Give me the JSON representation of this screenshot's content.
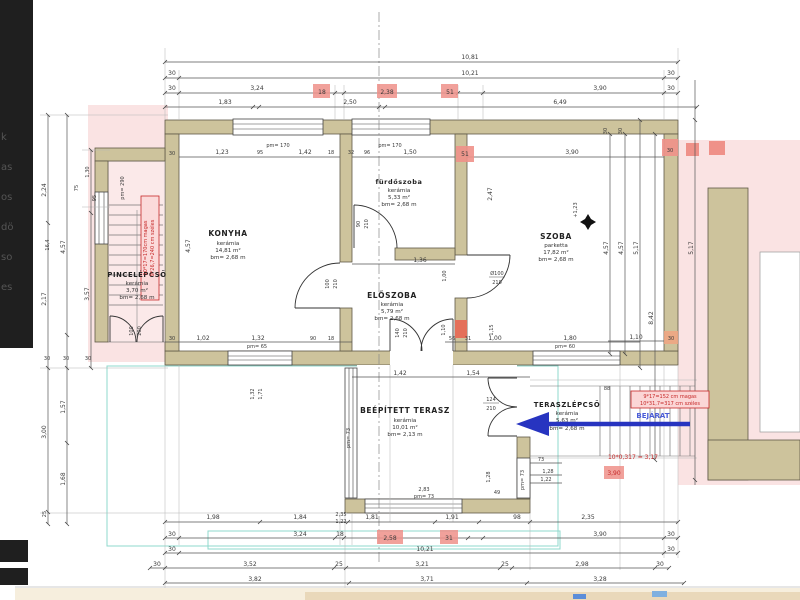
{
  "colors": {
    "wall": "#cdc39c",
    "pink_overlay": "#fae3e3",
    "red_highlight": "#ef9189",
    "red_wall_segment": "#e4705a",
    "red_note": "#c62828",
    "cyan_box": "#8fd8cc",
    "blue_arrow": "#2734c0",
    "blue_text": "#4a5cd8",
    "bottom_strip_tan": "#e9d8ba",
    "bottom_strip_cream": "#f6eedd"
  },
  "rooms": [
    {
      "name": "KONYHA",
      "material": "kerámia",
      "area": "14,81 m²",
      "height": "bm= 2,68 m"
    },
    {
      "name": "fürdőszoba",
      "material": "kerámia",
      "area": "5,33 m²",
      "height": "bm= 2,68 m"
    },
    {
      "name": "SZOBA",
      "material": "parketta",
      "area": "17,82 m²",
      "height": "bm= 2,68 m"
    },
    {
      "name": "ELŐSZOBA",
      "material": "kerámia",
      "area": "5,79 m²",
      "height": "bm= 2,68 m"
    },
    {
      "name": "PINCELÉPCSŐ",
      "material": "kerámia",
      "area": "3,70 m²",
      "height": "bm= 2,68 m"
    },
    {
      "name": "BEÉPÍTETT TERASZ",
      "material": "kerámia",
      "area": "10,01 m²",
      "height": "bm= 2,13 m"
    },
    {
      "name": "TERASZLÉPCSŐ",
      "material": "kerámia",
      "area": "5,63 m²",
      "height": "bm= 2,68 m"
    }
  ],
  "entrance": {
    "label": "BEJÁRAT"
  },
  "notes": {
    "basement_stairs_line1": "10*17=170cm magas",
    "basement_stairs_line2": "9*26,7=240 cm széles",
    "terrace_stairs_line1": "9*17=152 cm magas",
    "terrace_stairs_line2": "10*31,7=317 cm széles",
    "stair_calc": "10*0,317 = 3,17",
    "dim_390": "3,90",
    "level_marker": "+1,23"
  },
  "door_labels": {
    "konyha": [
      "100",
      "210"
    ],
    "bath": [
      "90",
      "210"
    ],
    "szoba": [
      "Ø100",
      "210"
    ],
    "entrance_door": [
      "140",
      "210"
    ],
    "basement": [
      "100",
      "200"
    ],
    "terrace": [
      "124",
      "210"
    ]
  },
  "window_labels": {
    "top1": "pm= 170",
    "top2": "pm= 170",
    "konyha_bottom": "pm= 65",
    "szoba_bottom": "pm= 60",
    "basement": "pm= 290",
    "terrace_left": "pm= 73",
    "terrace_bottom": "pm= 73",
    "terrace_right": "pm= 73",
    "terrace_width": "2,83"
  },
  "dims": {
    "t1": [
      "10,81"
    ],
    "t2": [
      "30",
      "10,21",
      "30"
    ],
    "t3": [
      "30",
      "3,24",
      "18",
      "2,38",
      "51",
      "3,90",
      "30"
    ],
    "t4": [
      "1,83",
      "2,50",
      "6,49"
    ],
    "b1": [
      "1,98",
      "1,84",
      "1,81",
      "1,91",
      "98",
      "2,35"
    ],
    "b2": [
      "30",
      "3,24",
      "18",
      "2,58",
      "31",
      "3,90",
      "30"
    ],
    "b3": [
      "30",
      "10,21",
      "30"
    ],
    "b4": [
      "30",
      "3,52",
      "25",
      "3,21",
      "25",
      "2,98",
      "30"
    ],
    "b5": [
      "3,82",
      "3,71",
      "3,28"
    ],
    "l1": [
      "2,24",
      "16,4",
      "2,17",
      "3,00",
      "25"
    ],
    "l2": [
      "4,57",
      "1,57",
      "1,68"
    ],
    "l3": [
      "1,30",
      "3,57",
      "75",
      "95"
    ],
    "l4": [
      "30",
      "30",
      "30"
    ],
    "r1": [
      "4,57",
      "4,57",
      "5,17",
      "5,17",
      "8,42"
    ],
    "r2": [
      "30",
      "30"
    ],
    "r3": [
      "1,10",
      "30"
    ],
    "szoba_corner": "30",
    "konyha_top": [
      "30",
      "1,23",
      "95",
      "1,42",
      "18"
    ],
    "bath_top": [
      "32",
      "96",
      "1,50",
      "51"
    ],
    "szoba_top": [
      "3,90"
    ],
    "konyha_left": "4,57",
    "szoba_left": "2,47",
    "konyha_bottom": [
      "30",
      "1,02",
      "1,32",
      "90",
      "18"
    ],
    "konyha_below": [
      "1,32",
      "1,71"
    ],
    "hall_top": [
      "1,36",
      "1,00"
    ],
    "hall_mid": [
      "1,10",
      "1,15"
    ],
    "hall_bottom": [
      "56",
      "31",
      "1,00",
      "1,80"
    ],
    "terasz_top": [
      "1,42",
      "1,54"
    ],
    "terasz_misc": [
      "2,35",
      "1,22",
      "49",
      "1,28"
    ],
    "stairs_right": [
      "73",
      "1,28",
      "1,22",
      "88"
    ]
  },
  "sidebar_fragments": [
    "k",
    "as",
    "os",
    "dö",
    "so",
    "es"
  ]
}
